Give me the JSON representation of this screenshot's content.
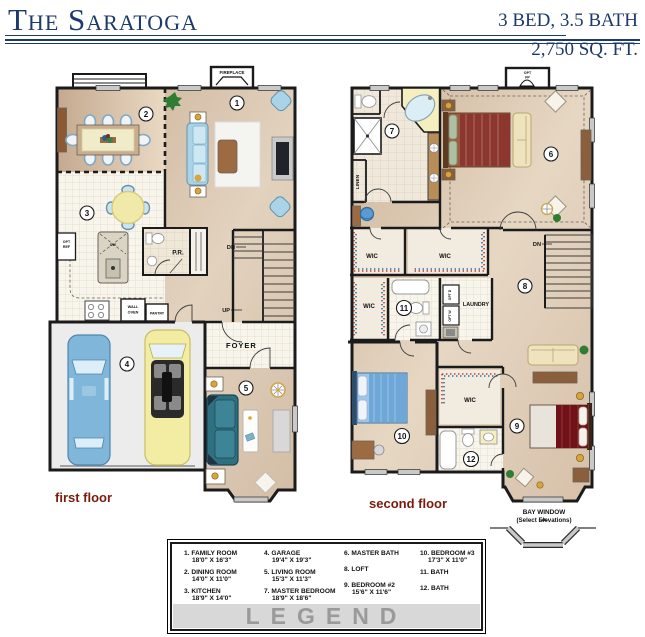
{
  "header": {
    "title": "The Saratoga",
    "bed_bath": "3 BED, 3.5 BATH",
    "sqft": "2,750 SQ. FT."
  },
  "colors": {
    "navy": "#1c3a6b",
    "maroon": "#7a1b0d",
    "legend_gray": "#9a9a9a"
  },
  "floors": {
    "first": {
      "caption": "first floor",
      "labels": {
        "fireplace": "FIREPLACE",
        "pr": "P.R.",
        "dn": "DN",
        "up": "UP",
        "foyer": "FOYER",
        "wall_oven_1": "WALL",
        "wall_oven_2": "OVEN",
        "pantry": "PANTRY",
        "opt_ref_1": "OPT",
        "opt_ref_2": "REF",
        "dw": "DW"
      },
      "numbers": {
        "family": "1",
        "dining": "2",
        "kitchen": "3",
        "garage": "4",
        "living": "5"
      }
    },
    "second": {
      "caption": "second floor",
      "labels": {
        "opt_fp_1": "OPT",
        "opt_fp_2": "FP",
        "linen": "LINEN",
        "wic": "WIC",
        "laundry": "LAUNDRY",
        "opt_d": "OPT D",
        "opt_w": "OPT W",
        "dn": "DN",
        "bay_window": "BAY WINDOW",
        "bay_window_sub": "(Select Elevations)"
      },
      "numbers": {
        "master_bedroom": "6",
        "master_bath": "7",
        "loft": "8",
        "bedroom2": "9",
        "bedroom3": "10",
        "bath_a": "11",
        "bath_b": "12"
      }
    }
  },
  "legend": {
    "title": "LEGEND",
    "columns": [
      [
        {
          "label": "1. FAMILY ROOM",
          "dims": "18'0\" X 16'3\""
        },
        {
          "label": "2. DINING ROOM",
          "dims": "14'0\" X 11'0\""
        },
        {
          "label": "3. KITCHEN",
          "dims": "18'9\" X 14'0\""
        }
      ],
      [
        {
          "label": "4. GARAGE",
          "dims": "19'4\" X 19'3\""
        },
        {
          "label": "5. LIVING ROOM",
          "dims": "15'3\" X 11'3\""
        },
        {
          "label": "7. MASTER BEDROOM",
          "dims": "18'9\" X 18'6\""
        }
      ],
      [
        {
          "label": "6. MASTER BATH",
          "dims": ""
        },
        {
          "label": "8. LOFT",
          "dims": ""
        },
        {
          "label": "9. BEDROOM #2",
          "dims": "15'6\" X 11'6\""
        }
      ],
      [
        {
          "label": "10. BEDROOM #3",
          "dims": "17'3\" X 11'0\""
        },
        {
          "label": "11. BATH",
          "dims": ""
        },
        {
          "label": "12. BATH",
          "dims": ""
        }
      ]
    ]
  }
}
